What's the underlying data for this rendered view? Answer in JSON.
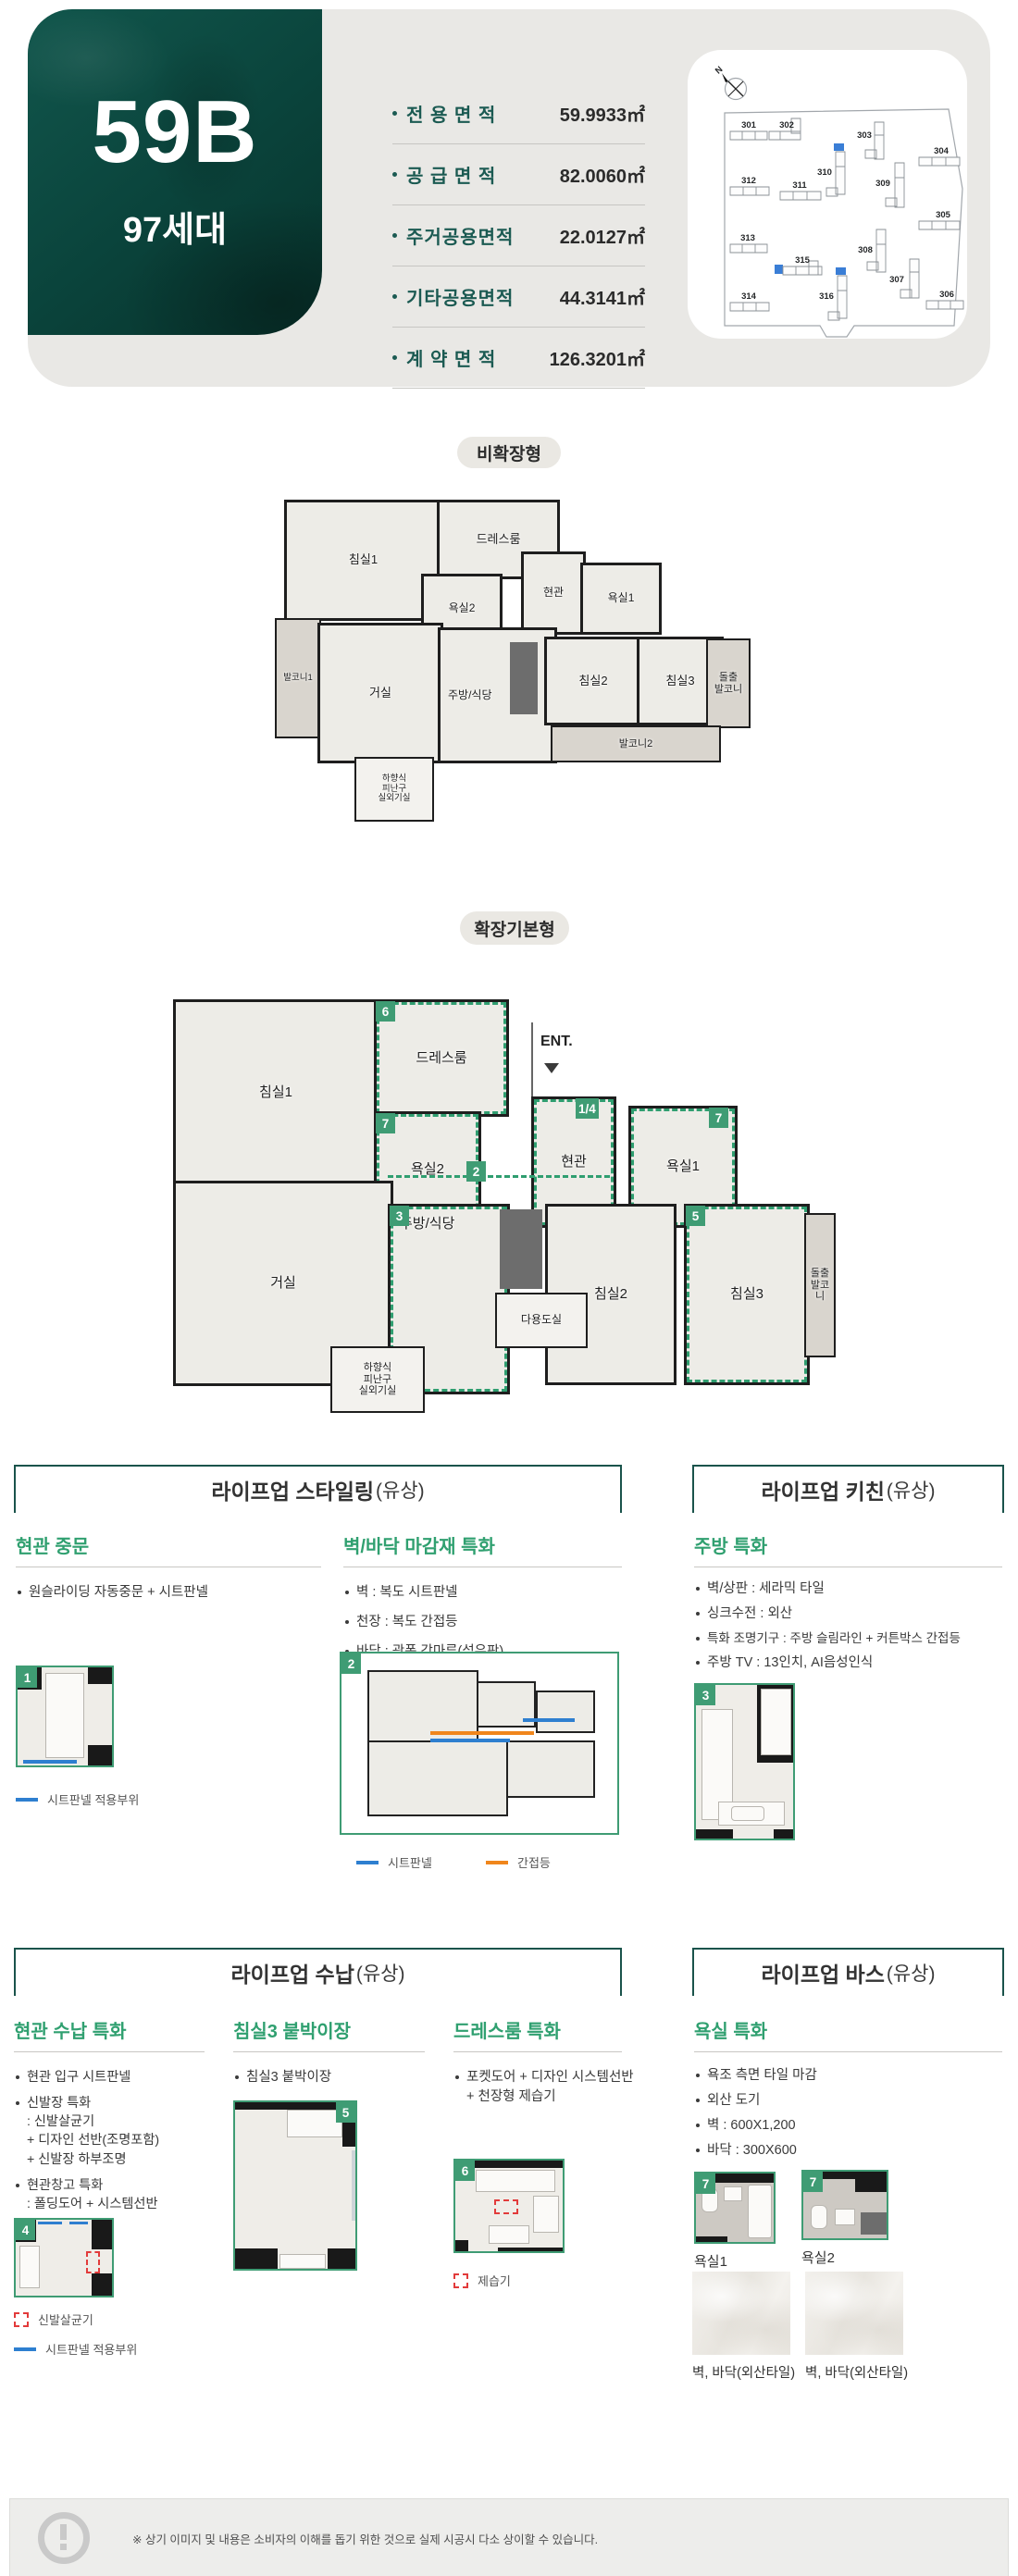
{
  "header": {
    "unit_code": "59B",
    "unit_count": "97세대",
    "areas": [
      {
        "label": "전 용 면 적",
        "value": "59.9933㎡"
      },
      {
        "label": "공 급 면 적",
        "value": "82.0060㎡"
      },
      {
        "label": "주거공용면적",
        "value": "22.0127㎡"
      },
      {
        "label": "기타공용면적",
        "value": "44.3141㎡"
      },
      {
        "label": "계 약 면 적",
        "value": "126.3201㎡"
      }
    ]
  },
  "site_map": {
    "north": "N",
    "buildings": [
      {
        "no": "301"
      },
      {
        "no": "302"
      },
      {
        "no": "303"
      },
      {
        "no": "304"
      },
      {
        "no": "310"
      },
      {
        "no": "312"
      },
      {
        "no": "311"
      },
      {
        "no": "309"
      },
      {
        "no": "305"
      },
      {
        "no": "313"
      },
      {
        "no": "308"
      },
      {
        "no": "315"
      },
      {
        "no": "307"
      },
      {
        "no": "316"
      },
      {
        "no": "314"
      },
      {
        "no": "306"
      }
    ]
  },
  "plans": {
    "basic": {
      "title": "비확장형",
      "rooms": {
        "bed1": "침실1",
        "dress": "드레스룸",
        "bath2": "욕실2",
        "entry": "현관",
        "bath1": "욕실1",
        "balcony1": "발코니1",
        "living": "거실",
        "kitchen": "주방/식당",
        "bed2": "침실2",
        "bed3": "침실3",
        "jut": "돌출\n발코니",
        "balcony2": "발코니2",
        "escape": "하향식\n피난구\n실외기실"
      }
    },
    "expanded": {
      "title": "확장기본형",
      "ent": "ENT.",
      "rooms": {
        "bed1": "침실1",
        "dress": "드레스룸",
        "bath2": "욕실2",
        "entry": "현관",
        "bath1": "욕실1",
        "living": "거실",
        "kitchen": "주방/식당",
        "bed2": "침실2",
        "bed3": "침실3",
        "jut": "돌출\n발코니",
        "utility": "다용도실",
        "escape": "하향식\n피난구\n실외기실"
      },
      "badges": {
        "dress": "6",
        "bath2": "7",
        "entry": "1/4",
        "bath1": "7",
        "corridor": "2",
        "kitchen": "3",
        "bed3": "5"
      }
    }
  },
  "sections": {
    "styling": {
      "title": "라이프업 스타일링",
      "suffix": "(유상)",
      "door": {
        "title": "현관 중문",
        "bullets": [
          "원슬라이딩 자동중문 + 시트판넬"
        ],
        "badge": "1",
        "legend": "시트판넬 적용부위"
      },
      "finish": {
        "title": "벽/바닥 마감재 특화",
        "bullets": [
          "벽 : 복도 시트판넬",
          "천장 : 복도 간접등",
          "바닥 : 광폭 강마루(섬유판)"
        ],
        "badge": "2",
        "legend_sheet": "시트판넬",
        "legend_light": "간접등"
      }
    },
    "kitchen": {
      "title": "라이프업 키친",
      "suffix": "(유상)",
      "feature": {
        "title": "주방 특화",
        "bullets": [
          "벽/상판 : 세라믹 타일",
          "싱크수전 : 외산",
          "특화 조명기구 : 주방 슬림라인 + 커튼박스 간접등",
          "주방 TV : 13인치, AI음성인식"
        ],
        "badge": "3"
      }
    },
    "storage": {
      "title": "라이프업 수납",
      "suffix": "(유상)",
      "entry": {
        "title": "현관 수납 특화",
        "bullets": [
          "현관 입구 시트판넬",
          "신발장 특화\n: 신발살균기\n  + 디자인 선반(조명포함)\n  + 신발장 하부조명",
          "현관창고 특화\n: 폴딩도어 + 시스템선반"
        ],
        "badge": "4",
        "legend_red": "신발살균기",
        "legend_blue": "시트판넬 적용부위"
      },
      "closet": {
        "title": "침실3 붙박이장",
        "bullets": [
          "침실3 붙박이장"
        ],
        "badge": "5"
      },
      "dress": {
        "title": "드레스룸 특화",
        "bullets": [
          "포켓도어 + 디자인 시스템선반\n+ 천장형 제습기"
        ],
        "badge": "6",
        "legend_red": "제습기"
      }
    },
    "bath": {
      "title": "라이프업 바스",
      "suffix": "(유상)",
      "feature": {
        "title": "욕실 특화",
        "bullets": [
          "욕조 측면 타일 마감",
          "외산 도기",
          "벽 : 600X1,200",
          "바닥 : 300X600"
        ],
        "thumbs": [
          {
            "badge": "7",
            "label": "욕실1"
          },
          {
            "badge": "7",
            "label": "욕실2"
          }
        ],
        "tiles": [
          {
            "label": "벽, 바닥(외산타일)"
          },
          {
            "label": "벽, 바닥(외산타일)"
          }
        ]
      }
    }
  },
  "footer": {
    "note": "※ 상기 이미지 및 내용은 소비자의 이해를 돕기 위한 것으로 실제 시공시 다소 상이할 수 있습니다."
  },
  "colors": {
    "accent_teal": "#1a534b",
    "badge_green": "#3f9c74",
    "line_blue": "#2e7fd0",
    "line_orange": "#f0861c",
    "dash_red": "#e23b3b",
    "highlight_blue": "#3a7ed6"
  }
}
